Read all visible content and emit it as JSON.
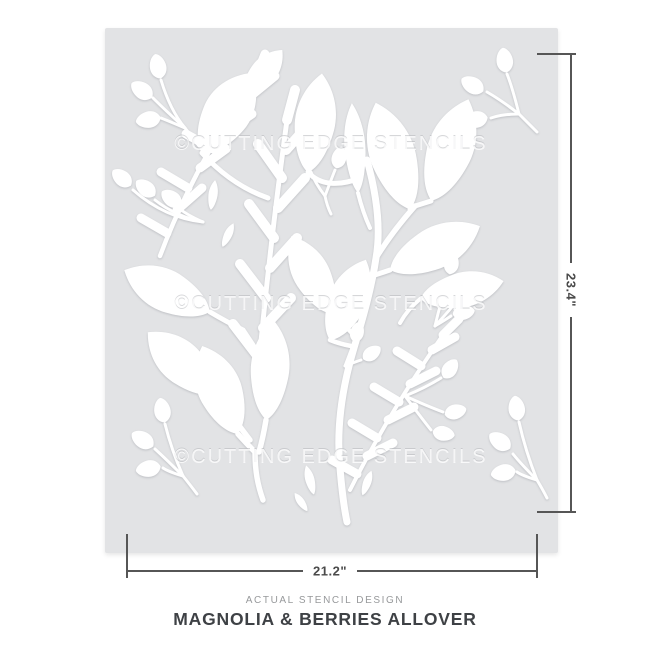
{
  "stencil": {
    "watermark_text": "©CUTTING EDGE STENCILS",
    "sheet_color": "#e2e3e5",
    "cutout_color": "#ffffff"
  },
  "dimensions": {
    "height_label": "23.4\"",
    "width_label": "21.2\"",
    "line_color": "#565656"
  },
  "caption": {
    "kicker": "ACTUAL STENCIL DESIGN",
    "title": "MAGNOLIA & BERRIES ALLOVER"
  }
}
